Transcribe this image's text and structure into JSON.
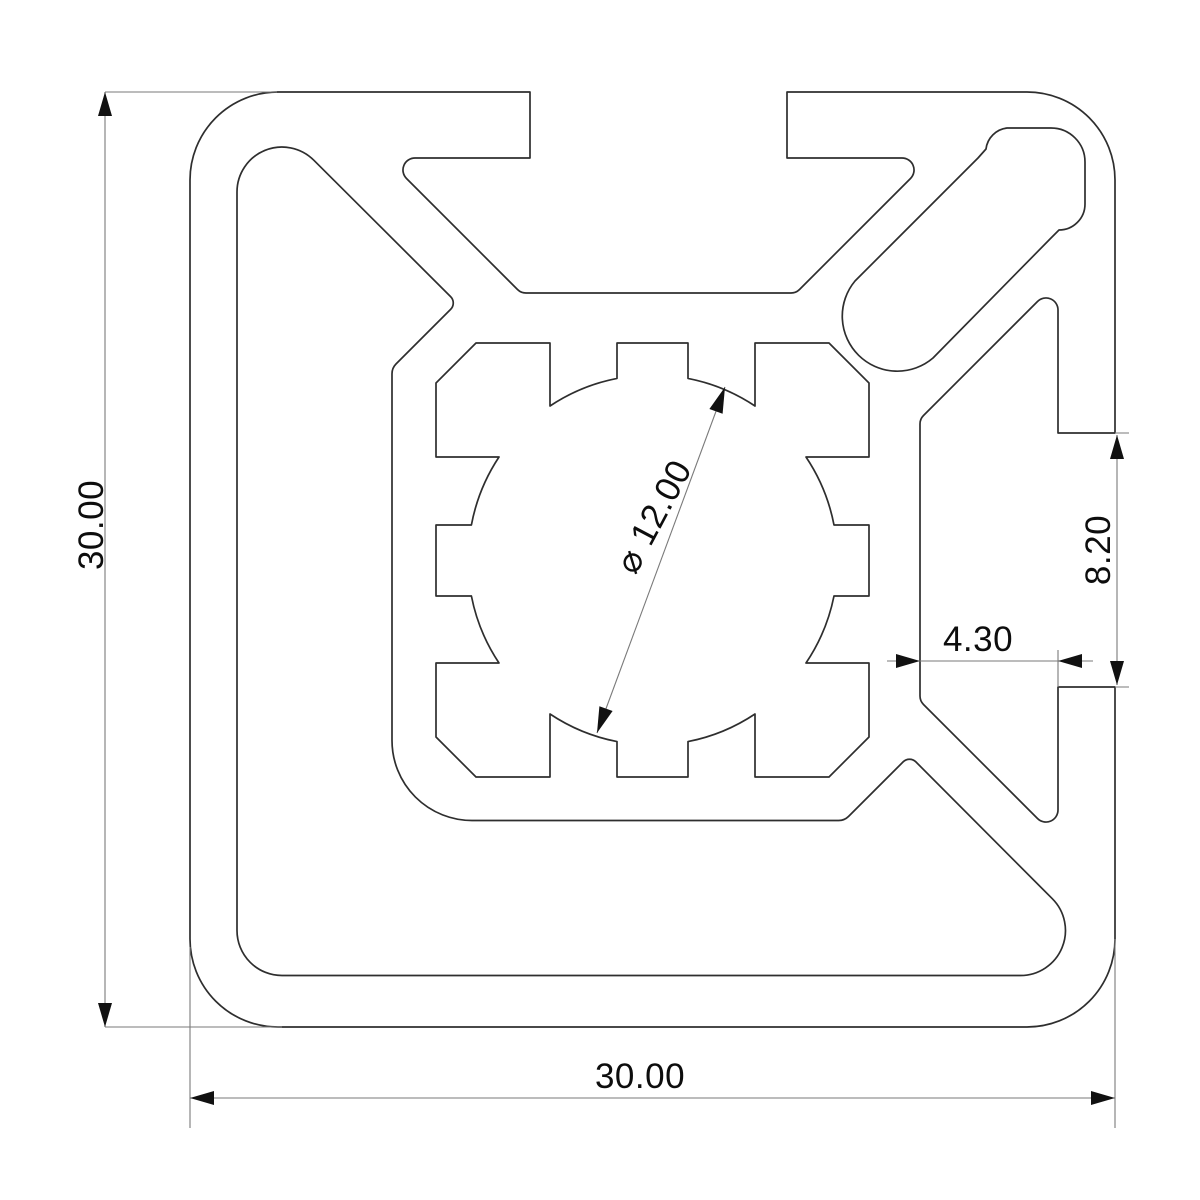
{
  "drawing": {
    "type": "cad-cross-section",
    "subject": "30x30 aluminium extrusion profile with two T-slots, centre bore and corner channel",
    "background_color": "#ffffff",
    "outline_color": "#2e2e2e",
    "dimension_color": "#7a7a7a",
    "text_color": "#0d0d0d",
    "dimensions": {
      "overall_height_label": "30.00",
      "overall_width_label": "30.00",
      "bore_diameter_label": "⌀ 12.00",
      "slot_opening_label": "8.20",
      "slot_depth_label": "4.30"
    }
  }
}
